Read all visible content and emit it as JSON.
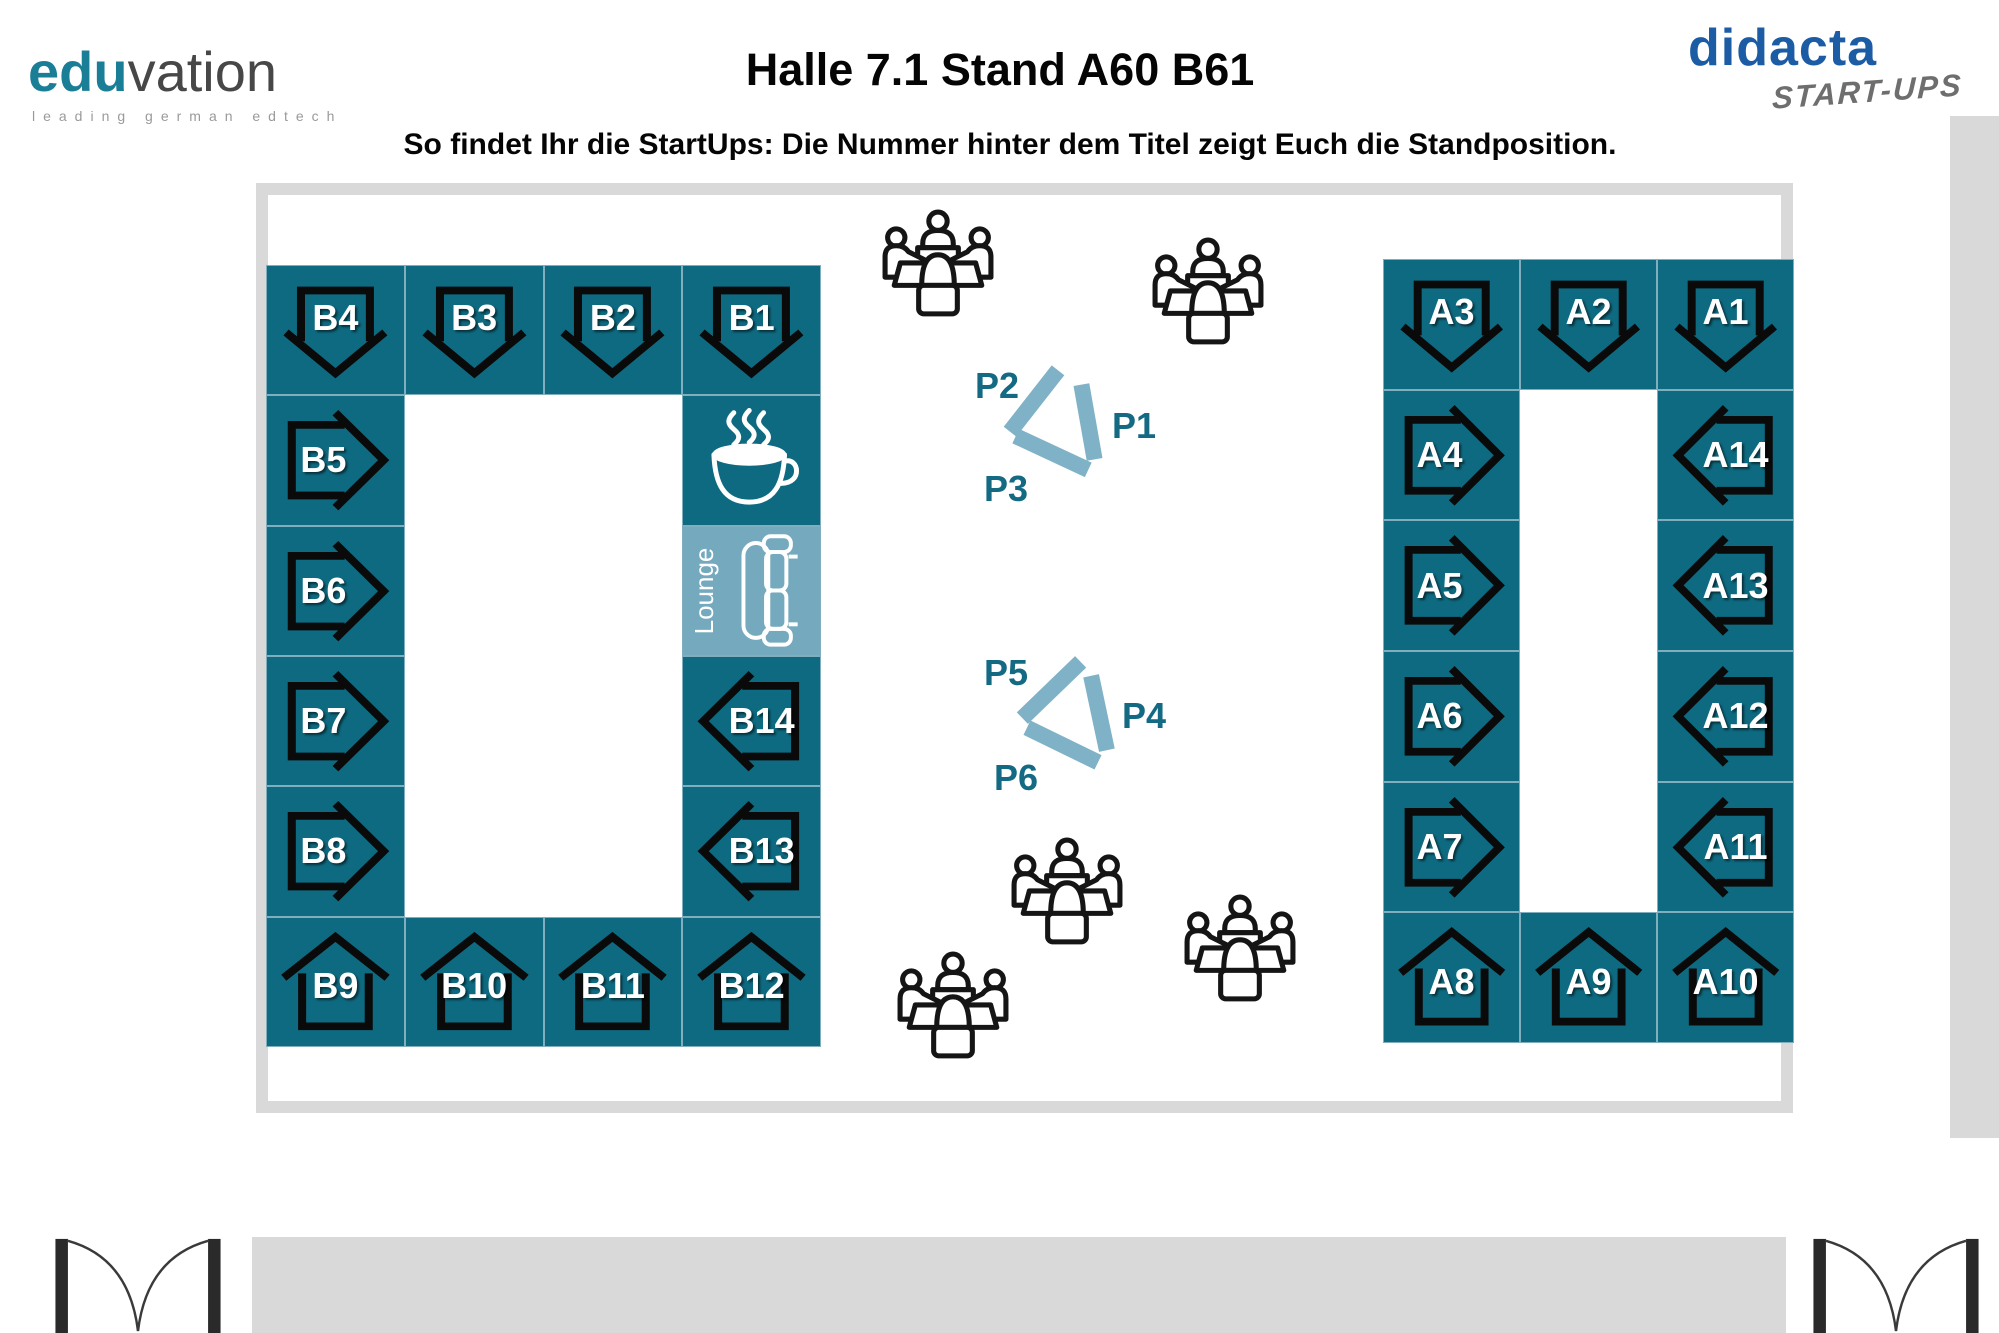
{
  "header": {
    "logo": {
      "part1": "edu",
      "part2": "vation",
      "tagline": "leading german edtech"
    },
    "title": "Halle 7.1 Stand A60 B61",
    "subtitle": "So findet Ihr die StartUps: Die Nummer hinter dem Titel zeigt Euch die Standposition.",
    "didacta": {
      "name": "didacta",
      "sub": "START-UPS"
    }
  },
  "colors": {
    "booth_teal": "#0E6A80",
    "lounge_teal": "#74A9BE",
    "presentation_bar": "#7FB2C6",
    "presentation_label": "#136A82",
    "didacta_blue": "#1C5CA5",
    "eduvation_teal": "#1B7E97",
    "frame_gray": "#D9D9D9"
  },
  "plan": {
    "lounge_label": "Lounge",
    "blocks": [
      {
        "id": "b",
        "tiles": [
          {
            "label": "B4",
            "icon": "arrow-down",
            "col": 1,
            "row": 1
          },
          {
            "label": "B3",
            "icon": "arrow-down",
            "col": 2,
            "row": 1
          },
          {
            "label": "B2",
            "icon": "arrow-down",
            "col": 3,
            "row": 1
          },
          {
            "label": "B1",
            "icon": "arrow-down",
            "col": 4,
            "row": 1
          },
          {
            "label": "B5",
            "icon": "arrow-right",
            "col": 1,
            "row": 2
          },
          {
            "label": "",
            "icon": "coffee",
            "col": 4,
            "row": 2
          },
          {
            "label": "B6",
            "icon": "arrow-right",
            "col": 1,
            "row": 3
          },
          {
            "label": "Lounge",
            "icon": "lounge",
            "col": 4,
            "row": 3
          },
          {
            "label": "B7",
            "icon": "arrow-right",
            "col": 1,
            "row": 4
          },
          {
            "label": "B14",
            "icon": "arrow-left",
            "col": 4,
            "row": 4
          },
          {
            "label": "B8",
            "icon": "arrow-right",
            "col": 1,
            "row": 5
          },
          {
            "label": "B13",
            "icon": "arrow-left",
            "col": 4,
            "row": 5
          },
          {
            "label": "B9",
            "icon": "house",
            "col": 1,
            "row": 6
          },
          {
            "label": "B10",
            "icon": "house",
            "col": 2,
            "row": 6
          },
          {
            "label": "B11",
            "icon": "house",
            "col": 3,
            "row": 6
          },
          {
            "label": "B12",
            "icon": "house",
            "col": 4,
            "row": 6
          }
        ]
      },
      {
        "id": "a",
        "tiles": [
          {
            "label": "A3",
            "icon": "arrow-down",
            "col": 1,
            "row": 1
          },
          {
            "label": "A2",
            "icon": "arrow-down",
            "col": 2,
            "row": 1
          },
          {
            "label": "A1",
            "icon": "arrow-down",
            "col": 3,
            "row": 1
          },
          {
            "label": "A4",
            "icon": "arrow-right",
            "col": 1,
            "row": 2
          },
          {
            "label": "A14",
            "icon": "arrow-left",
            "col": 3,
            "row": 2
          },
          {
            "label": "A5",
            "icon": "arrow-right",
            "col": 1,
            "row": 3
          },
          {
            "label": "A13",
            "icon": "arrow-left",
            "col": 3,
            "row": 3
          },
          {
            "label": "A6",
            "icon": "arrow-right",
            "col": 1,
            "row": 4
          },
          {
            "label": "A12",
            "icon": "arrow-left",
            "col": 3,
            "row": 4
          },
          {
            "label": "A7",
            "icon": "arrow-right",
            "col": 1,
            "row": 5
          },
          {
            "label": "A11",
            "icon": "arrow-left",
            "col": 3,
            "row": 5
          },
          {
            "label": "A8",
            "icon": "house",
            "col": 1,
            "row": 6
          },
          {
            "label": "A9",
            "icon": "house",
            "col": 2,
            "row": 6
          },
          {
            "label": "A10",
            "icon": "house",
            "col": 3,
            "row": 6
          }
        ]
      }
    ],
    "p_groups": [
      {
        "labels": [
          {
            "text": "P2",
            "x": 975,
            "y": 365
          },
          {
            "text": "P1",
            "x": 1112,
            "y": 405
          },
          {
            "text": "P3",
            "x": 984,
            "y": 468
          }
        ],
        "bars": [
          {
            "cx": 1034,
            "cy": 401,
            "len": 78,
            "ang": 128
          },
          {
            "cx": 1088,
            "cy": 422,
            "len": 76,
            "ang": 80
          },
          {
            "cx": 1052,
            "cy": 453,
            "len": 80,
            "ang": 25
          }
        ]
      },
      {
        "labels": [
          {
            "text": "P5",
            "x": 984,
            "y": 652
          },
          {
            "text": "P4",
            "x": 1122,
            "y": 695
          },
          {
            "text": "P6",
            "x": 994,
            "y": 757
          }
        ],
        "bars": [
          {
            "cx": 1051,
            "cy": 690,
            "len": 81,
            "ang": 136
          },
          {
            "cx": 1099,
            "cy": 713,
            "len": 76,
            "ang": 78
          },
          {
            "cx": 1062,
            "cy": 745,
            "len": 79,
            "ang": 26
          }
        ]
      }
    ],
    "people_positions": [
      [
        938,
        265
      ],
      [
        1208,
        293
      ],
      [
        1067,
        893
      ],
      [
        953,
        1007
      ],
      [
        1240,
        950
      ]
    ]
  }
}
